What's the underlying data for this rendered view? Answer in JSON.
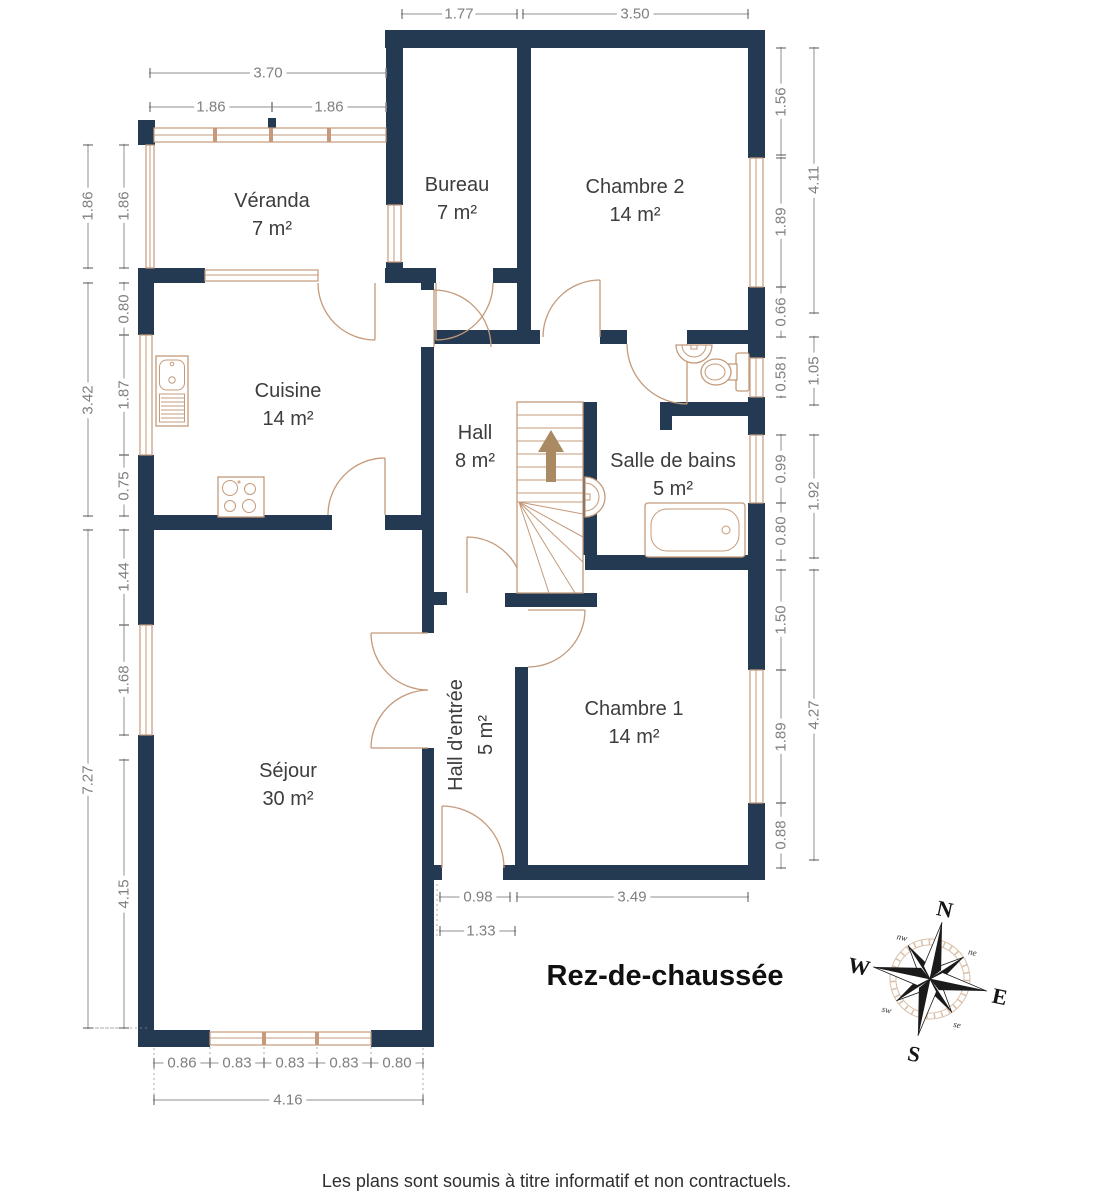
{
  "floor": {
    "title": "Rez-de-chaussée",
    "footer": "Les plans sont soumis à titre informatif et non contractuels."
  },
  "rooms": {
    "veranda": {
      "name": "Véranda",
      "area": "7 m²"
    },
    "bureau": {
      "name": "Bureau",
      "area": "7 m²"
    },
    "chambre2": {
      "name": "Chambre 2",
      "area": "14 m²"
    },
    "cuisine": {
      "name": "Cuisine",
      "area": "14 m²"
    },
    "hall": {
      "name": "Hall",
      "area": "8 m²"
    },
    "salle_de_bains": {
      "name": "Salle de bains",
      "area": "5 m²"
    },
    "sejour": {
      "name": "Séjour",
      "area": "30 m²"
    },
    "hall_entree": {
      "name": "Hall d'entrée",
      "area": "5 m²"
    },
    "chambre1": {
      "name": "Chambre 1",
      "area": "14 m²"
    }
  },
  "dims": {
    "top": {
      "bureau_width": "1.77",
      "chambre2_width": "3.50",
      "veranda_width": "3.70",
      "veranda_left": "1.86",
      "veranda_right": "1.86"
    },
    "left": {
      "veranda_height_outer": "1.86",
      "veranda_height_inner": "1.86",
      "cuisine_total": "3.42",
      "cuisine_wall_top": "0.80",
      "cuisine_window": "1.87",
      "cuisine_wall_bottom": "0.75",
      "sejour_total": "7.27",
      "sejour_wall_top": "1.44",
      "sejour_window": "1.68",
      "sejour_wall_bottom": "4.15"
    },
    "right": {
      "chambre2_total": "4.11",
      "chambre2_wall_top": "1.56",
      "chambre2_window": "1.89",
      "wc_wall": "0.66",
      "wc_window": "0.58",
      "wc_total": "1.05",
      "bath_window": "0.99",
      "bath_total": "1.92",
      "bath_wall": "0.80",
      "chambre1_wall_top": "1.50",
      "chambre1_window": "1.89",
      "chambre1_wall_bottom": "0.88",
      "chambre1_total": "4.27"
    },
    "bottom": {
      "entry_door": "0.98",
      "entry_width": "1.33",
      "chambre1_width": "3.49",
      "seg1": "0.86",
      "seg2": "0.83",
      "seg3": "0.83",
      "seg4": "0.83",
      "seg5": "0.80",
      "sejour_total": "4.16"
    }
  },
  "compass": {
    "north": "N",
    "east": "E",
    "south": "S",
    "west": "W",
    "northeast": "ne",
    "southeast": "se",
    "southwest": "sw",
    "northwest": "nw"
  },
  "colors": {
    "wall": "#243a52",
    "fixture": "#c49a7a",
    "dimension": "#8f8f8f",
    "dimension_text": "#7f7f7f",
    "label": "#3d3d3d",
    "stair_arrow": "#a98a63",
    "compass_ring": "#d9bfa7",
    "compass_star": "#1a1a1a"
  }
}
